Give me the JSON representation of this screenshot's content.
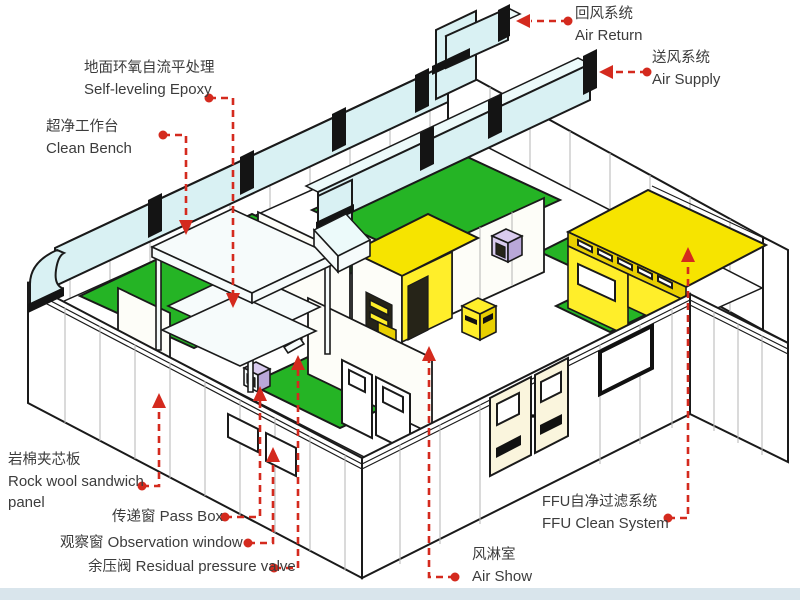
{
  "title": "Cleanroom system cutaway diagram",
  "colors": {
    "arrow": "#d42a1e",
    "duct_cyan": "#d9f1f3",
    "floor_green": "#25b425",
    "ffu_yellow": "#f6e400",
    "wall_white": "#ffffff",
    "outline": "#1a1a1a",
    "lavender_unit": "#d9cbee",
    "door_cream": "#faf5dd",
    "bottom_bar": "#d9e5ec"
  },
  "labels": {
    "air_return": {
      "zh": "回风系统",
      "en": "Air Return"
    },
    "air_supply": {
      "zh": "送风系统",
      "en": "Air Supply"
    },
    "self_leveling_epoxy": {
      "zh": "地面环氧自流平处理",
      "en": "Self-leveling Epoxy"
    },
    "clean_bench": {
      "zh": "超净工作台",
      "en": "Clean Bench"
    },
    "rock_wool": {
      "zh": "岩棉夹芯板",
      "en": "Rock wool sandwich",
      "en_line2": "panel"
    },
    "pass_box": {
      "zh": "传递窗",
      "en": "Pass Box"
    },
    "observation_window": {
      "zh": "观察窗",
      "en": "Observation window"
    },
    "residual_pressure_valve": {
      "zh": "余压阀",
      "en": "Residual pressure valve"
    },
    "air_shower": {
      "zh": "风淋室",
      "en": "Air Show"
    },
    "ffu": {
      "zh": "FFU自净过滤系统",
      "en": "FFU Clean System"
    }
  }
}
